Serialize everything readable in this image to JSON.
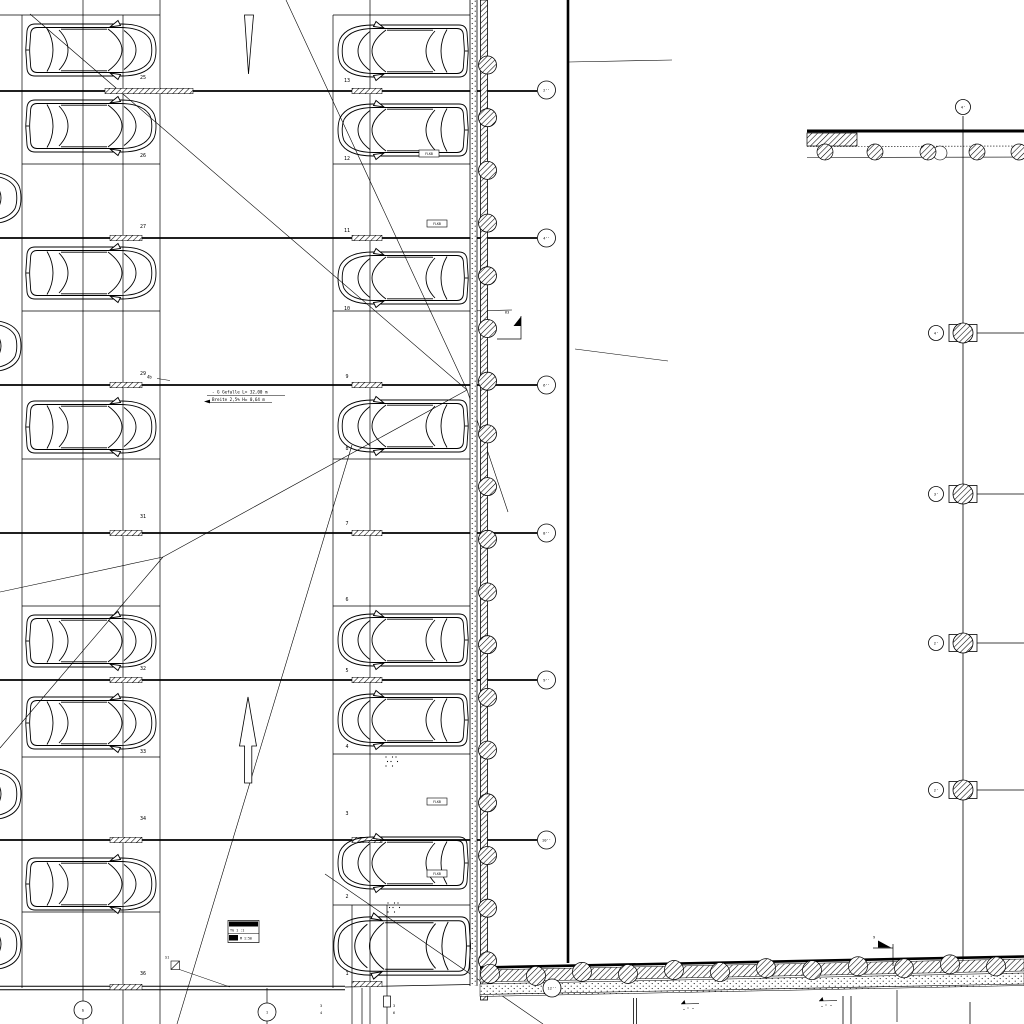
{
  "annotation": {
    "line1": "- G  Gefalle L= 32,00 m",
    "line2": "Breite 2,5%  H= 0,64 m",
    "ramp_note": "4b"
  },
  "stamp": {
    "r1": "PKW-EINST.",
    "r2": "TG 1 :1",
    "r3": "M 1:50"
  },
  "fbok_label": "FLKB",
  "markers": {
    "m1": "63",
    "m2": "9",
    "m3": "S1"
  },
  "stalls_left": [
    {
      "label": "25",
      "y": 79
    },
    {
      "label": "26",
      "y": 157
    },
    {
      "label": "27",
      "y": 228
    },
    {
      "label": "29",
      "y": 375
    },
    {
      "label": "31",
      "y": 518
    },
    {
      "label": "32",
      "y": 670
    },
    {
      "label": "33",
      "y": 753
    },
    {
      "label": "34",
      "y": 820
    },
    {
      "label": "36",
      "y": 975
    }
  ],
  "stalls_right": [
    {
      "label": "13",
      "y": 82
    },
    {
      "label": "12",
      "y": 160
    },
    {
      "label": "11",
      "y": 232
    },
    {
      "label": "10",
      "y": 310
    },
    {
      "label": "9",
      "y": 378
    },
    {
      "label": "8",
      "y": 450
    },
    {
      "label": "7",
      "y": 525
    },
    {
      "label": "6",
      "y": 601
    },
    {
      "label": "5",
      "y": 672
    },
    {
      "label": "4",
      "y": 748
    },
    {
      "label": "3",
      "y": 815
    },
    {
      "label": "2",
      "y": 898
    },
    {
      "label": "1",
      "y": 975
    }
  ],
  "cars": {
    "left_x": 91,
    "right_x": 403,
    "partial_x": -44,
    "left_y": [
      50,
      126,
      273,
      427,
      641,
      723,
      884
    ],
    "right_y": [
      51,
      130,
      278,
      426,
      640,
      720,
      863
    ],
    "partial_y": [
      198,
      346,
      794,
      944
    ],
    "suv": {
      "x": 402,
      "y": 946
    }
  },
  "grid": {
    "bubbles": [
      {
        "x": 546.5,
        "y": 90,
        "label": "2''"
      },
      {
        "x": 546.5,
        "y": 238,
        "label": "4''"
      },
      {
        "x": 546.5,
        "y": 385,
        "label": "6''"
      },
      {
        "x": 546.5,
        "y": 533,
        "label": "8''"
      },
      {
        "x": 546.5,
        "y": 680,
        "label": "9''"
      },
      {
        "x": 546.5,
        "y": 840,
        "label": "10''"
      },
      {
        "x": 83,
        "y": 1010,
        "label": "b"
      },
      {
        "x": 267,
        "y": 1012,
        "label": "1"
      },
      {
        "x": 552,
        "y": 988,
        "label": "12''"
      },
      {
        "x": 963,
        "y": 107,
        "label": "4'"
      },
      {
        "x": 936,
        "y": 333,
        "label": "4'"
      },
      {
        "x": 936,
        "y": 494,
        "label": "3'"
      },
      {
        "x": 936,
        "y": 643,
        "label": "2'"
      },
      {
        "x": 936,
        "y": 790,
        "label": "2'"
      }
    ],
    "thick_ys": [
      91,
      238,
      385,
      533,
      680,
      840
    ],
    "left_div_ys": [
      164,
      311,
      459,
      606,
      757,
      912
    ],
    "right_div_ys": [
      164,
      311,
      459,
      606,
      754,
      905
    ],
    "verticals": [
      [
        22,
        15,
        988,
        0.7
      ],
      [
        83,
        0,
        1001,
        0.7
      ],
      [
        123,
        15,
        1024,
        0.7
      ],
      [
        160,
        0,
        1024,
        0.7
      ],
      [
        333,
        15,
        988,
        0.7
      ],
      [
        370,
        0,
        1024,
        0.7
      ],
      [
        267,
        988,
        1003,
        0.7
      ],
      [
        352,
        905,
        1024,
        0.7
      ],
      [
        362,
        988,
        1024,
        0.7
      ],
      [
        387,
        905,
        1024,
        0.7
      ],
      [
        568,
        0,
        963,
        2.6
      ],
      [
        963,
        116,
        970,
        0.8
      ],
      [
        970,
        1002,
        1024,
        0.8
      ],
      [
        843,
        996,
        1024,
        0.8
      ],
      [
        851,
        996,
        1024,
        0.8
      ],
      [
        633.5,
        998,
        1024,
        0.8
      ],
      [
        636.5,
        998,
        1024,
        0.8
      ],
      [
        897,
        990,
        1022,
        0.7
      ],
      [
        83,
        1019,
        1024,
        0.7
      ],
      [
        267,
        1021,
        1024,
        0.7
      ]
    ],
    "top_lines": [
      [
        0,
        15,
        160,
        15
      ],
      [
        333,
        15,
        470,
        15
      ]
    ],
    "bottom_double": {
      "x2": 345,
      "y1": 986.3,
      "y2": 989.7
    },
    "stall1_bottom": [
      345,
      987,
      470,
      984.5
    ],
    "y311_ext": [
      470,
      311,
      512,
      310
    ],
    "leaders": [
      [
        569,
        62,
        672,
        60
      ],
      [
        575,
        349,
        668,
        361
      ]
    ],
    "diagonals": [
      [
        30,
        14,
        467,
        390
      ],
      [
        286,
        0,
        467,
        390
      ],
      [
        467,
        390,
        508,
        512
      ],
      [
        467,
        390,
        163,
        557
      ],
      [
        163,
        557,
        0,
        592
      ],
      [
        163,
        557,
        0,
        748
      ],
      [
        352,
        445,
        177,
        1024
      ],
      [
        325,
        874,
        543,
        1024
      ]
    ],
    "ticks_left": [
      [
        105,
        91,
        88
      ],
      [
        110,
        238,
        32
      ],
      [
        110,
        385,
        32
      ],
      [
        110,
        533,
        32
      ],
      [
        110,
        680,
        32
      ],
      [
        110,
        840,
        32
      ],
      [
        110,
        987,
        32
      ]
    ],
    "ticks_right": [
      [
        352,
        91,
        30
      ],
      [
        352,
        238,
        30
      ],
      [
        352,
        385,
        30
      ],
      [
        352,
        533,
        30
      ],
      [
        352,
        680,
        30
      ],
      [
        352,
        840,
        30
      ],
      [
        352,
        984,
        30
      ]
    ]
  },
  "columns": {
    "wall_x": 487.5,
    "wall_start_y": 65,
    "wall_step": 52.7,
    "wall_count": 18,
    "wall_r": 9,
    "right_grid_ys": [
      333,
      494,
      643,
      790
    ],
    "top_wall_xs": [
      825,
      875,
      928,
      977,
      1019
    ],
    "bottom_wall_xs": [
      490,
      536,
      582,
      628,
      674,
      720,
      766,
      812,
      858,
      904,
      950,
      996
    ]
  },
  "misc": {
    "fbok_boxes": [
      [
        419,
        150
      ],
      [
        427,
        220
      ],
      [
        427,
        798
      ],
      [
        427,
        870
      ]
    ],
    "dot_clusters": [
      [
        386,
        757
      ],
      [
        388,
        903
      ]
    ],
    "level_markers": [
      [
        690,
        1004
      ],
      [
        828,
        1001
      ]
    ],
    "tiny_pairs": [
      {
        "x": 320,
        "y": 1007,
        "a": "3",
        "b": "4"
      },
      {
        "x": 393,
        "y": 1007,
        "a": "3",
        "b": "6"
      }
    ],
    "small_rect": [
      383.5,
      996,
      7,
      11
    ]
  }
}
